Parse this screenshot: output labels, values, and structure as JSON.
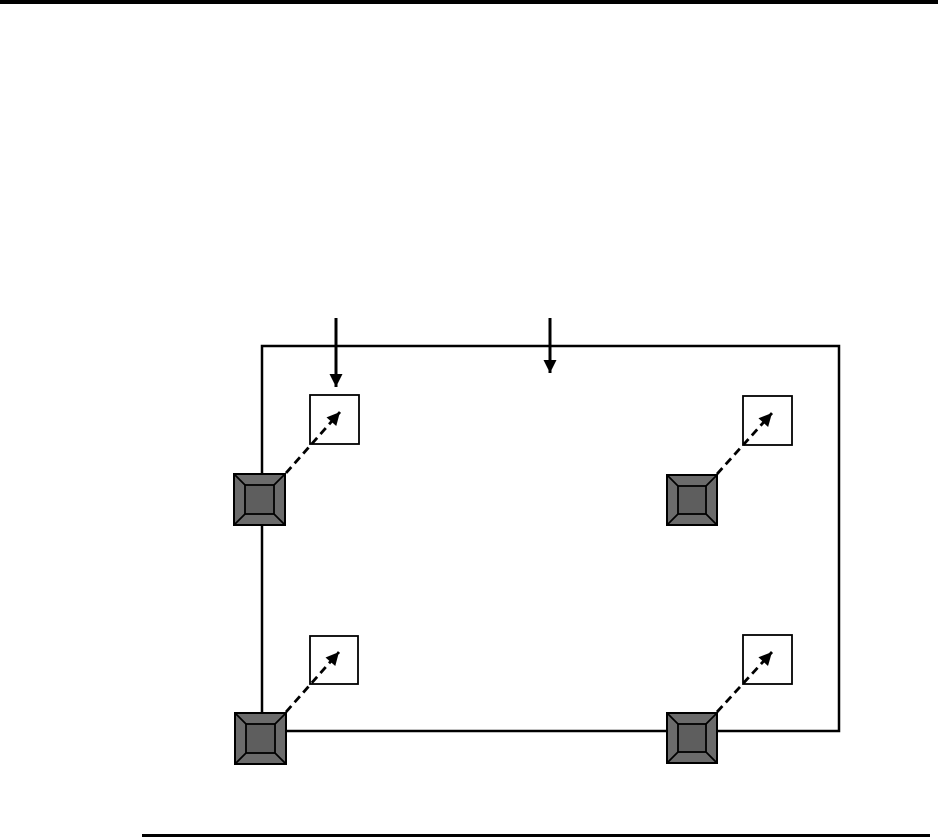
{
  "canvas": {
    "width": 938,
    "height": 839,
    "background": "#ffffff"
  },
  "colors": {
    "line": "#000000",
    "screw_face": "#6b6b6b",
    "screw_top": "#5e5e5e",
    "guide_square_fill": "#ffffff"
  },
  "rules": {
    "top_rule": {
      "x": 0,
      "y": 0,
      "width": 938,
      "height": 4
    },
    "footer_rule": {
      "x": 142,
      "y": 834,
      "width": 788,
      "height": 2.5
    }
  },
  "diagram": {
    "panel": {
      "x": 262,
      "y": 346,
      "width": 577,
      "height": 385,
      "stroke_width": 2.5
    },
    "insertion_arrows": [
      {
        "id": "insertion-arrow-left",
        "x": 336,
        "y1": 318,
        "y2": 387
      },
      {
        "id": "insertion-arrow-right",
        "x": 550,
        "y1": 318,
        "y2": 373
      }
    ],
    "screw_inset": 11,
    "screw_stroke": 1.8,
    "dash_pattern": "8 5",
    "arrow_stroke": 2.8,
    "fastener_groups": [
      {
        "id": "top-left",
        "screw": {
          "x": 234,
          "y": 474,
          "size": 51
        },
        "guide": {
          "x": 310,
          "y": 395,
          "size": 49
        },
        "arrow": {
          "x1": 286,
          "y1": 473,
          "x2": 340,
          "y2": 412
        }
      },
      {
        "id": "top-right",
        "screw": {
          "x": 667,
          "y": 475,
          "size": 50
        },
        "guide": {
          "x": 743,
          "y": 396,
          "size": 49
        },
        "arrow": {
          "x1": 717,
          "y1": 474,
          "x2": 772,
          "y2": 413
        }
      },
      {
        "id": "bottom-left",
        "screw": {
          "x": 235,
          "y": 713,
          "size": 51
        },
        "guide": {
          "x": 310,
          "y": 636,
          "size": 48
        },
        "arrow": {
          "x1": 286,
          "y1": 712,
          "x2": 339,
          "y2": 652
        }
      },
      {
        "id": "bottom-right",
        "screw": {
          "x": 667,
          "y": 713,
          "size": 50
        },
        "guide": {
          "x": 743,
          "y": 635,
          "size": 49
        },
        "arrow": {
          "x1": 717,
          "y1": 712,
          "x2": 772,
          "y2": 652
        }
      }
    ]
  }
}
